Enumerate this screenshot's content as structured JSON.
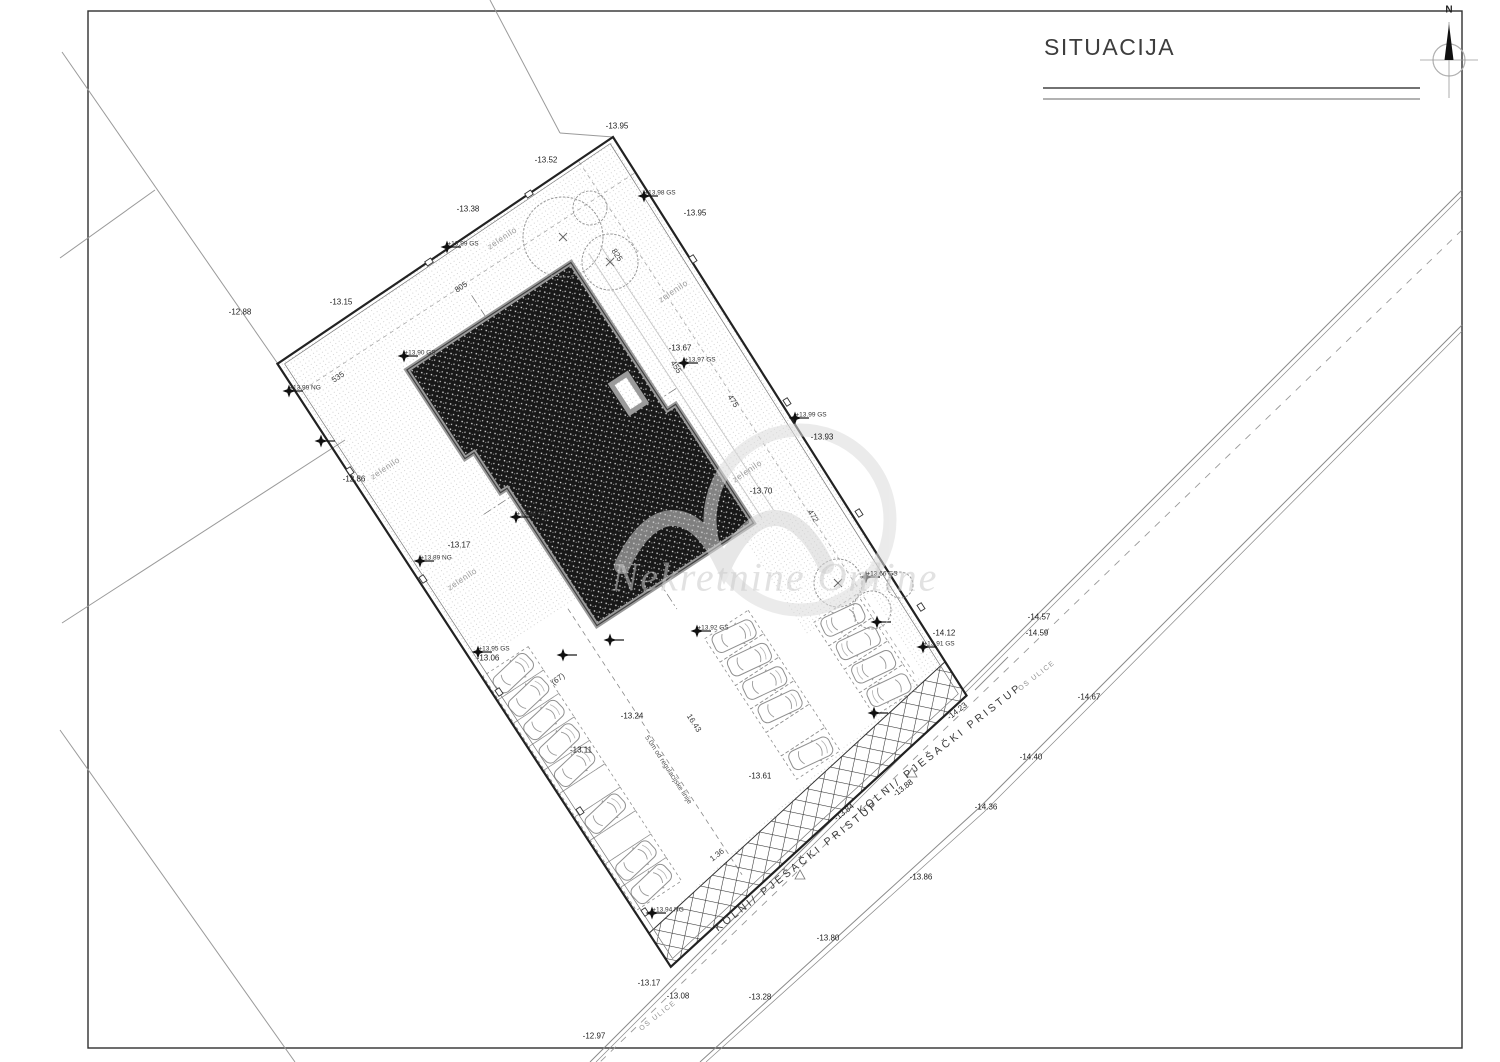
{
  "header": {
    "title": "SITUACIJA",
    "north_label": "N"
  },
  "watermark": {
    "text": "Nekretnine Online"
  },
  "labels": {
    "elevations": [
      "-13.95",
      "-13.52",
      "-13.38",
      "-13.95",
      "-13.15",
      "-12.88",
      "-12.86",
      "-13.17",
      "-13.67",
      "-13.93",
      "-13.70",
      "-13.06",
      "-13.24",
      "-13.11",
      "-13.61",
      "-14.12",
      "-14.57",
      "-14.59",
      "-14.67",
      "-14.40",
      "-14.36",
      "-14.23",
      "-13.88",
      "-13.84",
      "-13.86",
      "-13.80",
      "-13.17",
      "-13.08",
      "-13.28",
      "-12.97"
    ],
    "benchmarks": [
      "+13.99 GS",
      "+13.98 GS",
      "+13.90 GS",
      "+13.99 NG",
      "+13.96 GS",
      "+13.89 NG",
      "+13.95 GS",
      "+13.92 GS",
      "+13.99 GS",
      "+13.97 GS",
      "+13.66 GS",
      "+13.91 GS",
      "+13.94 NG"
    ],
    "dimensions": [
      "535",
      "805",
      "825",
      "455",
      "475",
      "472",
      "16.43",
      "1.36",
      "(67)"
    ],
    "green": [
      "zelenilo",
      "zelenilo",
      "zelenilo",
      "zelenilo",
      "zelenilo"
    ],
    "regulation": "5.0m od regulacijske linije",
    "access_road": [
      "KOLNI/ PJEŠAČKI PRISTUP",
      "KOLNI/ PJEŠAČKI PRISTUP"
    ],
    "street_axis": [
      "OS ULICE",
      "OS ULICE"
    ]
  }
}
